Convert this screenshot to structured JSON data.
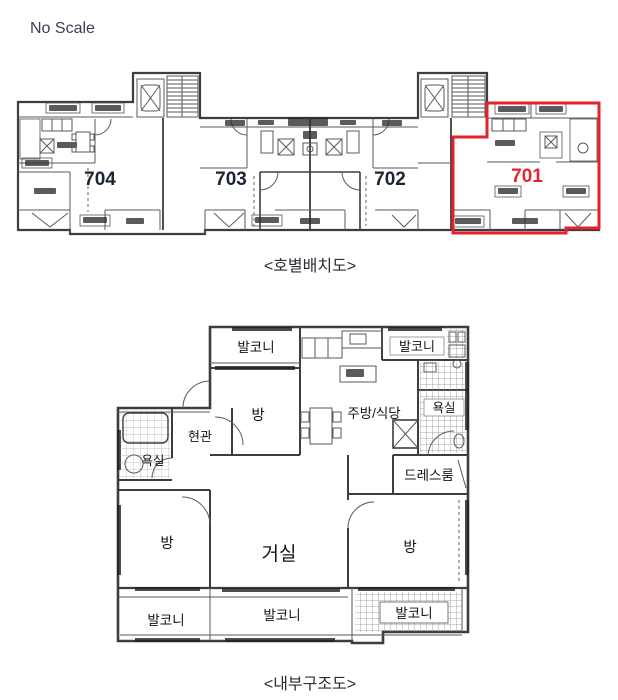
{
  "page": {
    "scale_note": "No Scale",
    "background_color": "#ffffff",
    "line_color": "#3d3d3d"
  },
  "unit_layout_diagram": {
    "caption": "<호별배치도>",
    "highlight_box_color": "#e5232b",
    "highlighted_unit": "701",
    "units": [
      {
        "number": "704",
        "color": "#1b2433"
      },
      {
        "number": "703",
        "color": "#1b2433"
      },
      {
        "number": "702",
        "color": "#1b2433"
      },
      {
        "number": "701",
        "color": "#e5232b"
      }
    ]
  },
  "interior_diagram": {
    "caption": "<내부구조도>",
    "rooms": {
      "balcony_top_left": "발코니",
      "balcony_top_right": "발코니",
      "bedroom_top": "방",
      "kitchen_dining": "주방/식당",
      "bathroom_right": "욕실",
      "entrance": "현관",
      "bathroom_left": "욕실",
      "dress_room": "드레스룸",
      "bedroom_left": "방",
      "living_room": "거실",
      "bedroom_right": "방",
      "balcony_bottom_left": "발코니",
      "balcony_bottom_center": "발코니",
      "balcony_bottom_right": "발코니"
    }
  }
}
